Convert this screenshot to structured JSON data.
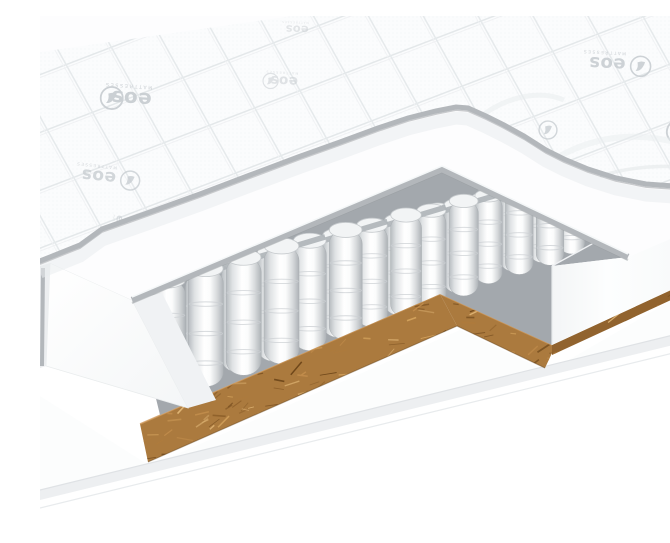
{
  "scene": {
    "kind": "product-render",
    "subject": "mattress-cutaway-cross-section",
    "background": "#ffffff"
  },
  "brand": {
    "name": "eos",
    "tagline": "MATTRESSES",
    "logo_color": "#c9ced2"
  },
  "colors": {
    "fabric": "#fbfcfd",
    "fabric_line": "#e6e9eb",
    "trim": "#b3b7bb",
    "trim_dark": "#94989c",
    "trim_highlight": "#f8fafb",
    "slab": "#fdfdfe",
    "chunk_left": "#fdfefe",
    "chunk_right": "#f0f2f4",
    "left_strip": "#eceef0",
    "field": "#a3a8ad",
    "felt": "#aeb4b8",
    "cap": "#f2f4f5",
    "spring_edge": "#a9aeb2",
    "block": "#fcfdfd",
    "coir_band": "#ab7a3e",
    "coir_strip": "#91632e",
    "coir_highlight": "#cf9a5c",
    "coir_shadow": "#5f3e16",
    "base_top": "#fcfdfd",
    "base_side": "#edeff1",
    "base_edge": "#dfe2e5"
  },
  "illustration": {
    "springs": {
      "ux": 0.958,
      "uy": -0.287,
      "ring_color": "#ccd0d3",
      "rows": [
        {
          "x": 128,
          "y": 382,
          "n": 4,
          "gap": 39.5,
          "w": 35.0,
          "h": 118
        },
        {
          "x": 162,
          "y": 367,
          "n": 5,
          "gap": 37.5,
          "w": 33.0,
          "h": 110
        },
        {
          "x": 196,
          "y": 352,
          "n": 6,
          "gap": 35.5,
          "w": 31.0,
          "h": 102
        },
        {
          "x": 230,
          "y": 338,
          "n": 7,
          "gap": 33.7,
          "w": 29.2,
          "h": 95
        },
        {
          "x": 264,
          "y": 323,
          "n": 9,
          "gap": 32.1,
          "w": 27.6,
          "h": 88
        },
        {
          "x": 298,
          "y": 308,
          "n": 11,
          "gap": 30.5,
          "w": 26.0,
          "h": 82
        },
        {
          "x": 332,
          "y": 294,
          "n": 12,
          "gap": 29.1,
          "w": 24.6,
          "h": 76
        },
        {
          "x": 366,
          "y": 279,
          "n": 13,
          "gap": 27.7,
          "w": 23.2,
          "h": 71
        },
        {
          "x": 398,
          "y": 266,
          "n": 13,
          "gap": 26.5,
          "w": 22.0,
          "h": 74
        }
      ]
    },
    "coir": {
      "strand_palette": [
        "#7a5122",
        "#8a5c28",
        "#b07c3d",
        "#c48f4e",
        "#d7a660",
        "#6b4418",
        "#e2b878"
      ],
      "band_count": 430,
      "strip_count": 150
    },
    "logos": [
      {
        "x": 100,
        "y": 84,
        "rot": 184,
        "scale": 1.05,
        "variant": "full",
        "side": 1,
        "op": 0.95
      },
      {
        "x": 66,
        "y": 162,
        "rot": 186,
        "scale": 0.9,
        "variant": "full",
        "side": -1,
        "op": 0.8
      },
      {
        "x": 250,
        "y": 66,
        "rot": 183,
        "scale": 0.72,
        "variant": "full",
        "side": 1,
        "op": 0.55
      },
      {
        "x": 575,
        "y": 49,
        "rot": 183,
        "scale": 0.95,
        "variant": "full",
        "side": -1,
        "op": 0.9
      },
      {
        "x": 508,
        "y": 114,
        "rot": 181,
        "scale": 0.85,
        "variant": "badge",
        "side": 0,
        "op": 0.8
      },
      {
        "x": 668,
        "y": 118,
        "rot": 184,
        "scale": 1.1,
        "variant": "full",
        "side": 1,
        "op": 0.9
      },
      {
        "x": 262,
        "y": 14,
        "rot": 182,
        "scale": 0.6,
        "variant": "text",
        "side": 0,
        "op": 0.5
      },
      {
        "x": 80,
        "y": 205,
        "rot": 97,
        "scale": 0.52,
        "variant": "text",
        "side": 0,
        "op": 0.6
      },
      {
        "x": 350,
        "y": 118,
        "rot": 183,
        "scale": 0.5,
        "variant": "badge",
        "side": 0,
        "op": 0.4
      }
    ]
  }
}
